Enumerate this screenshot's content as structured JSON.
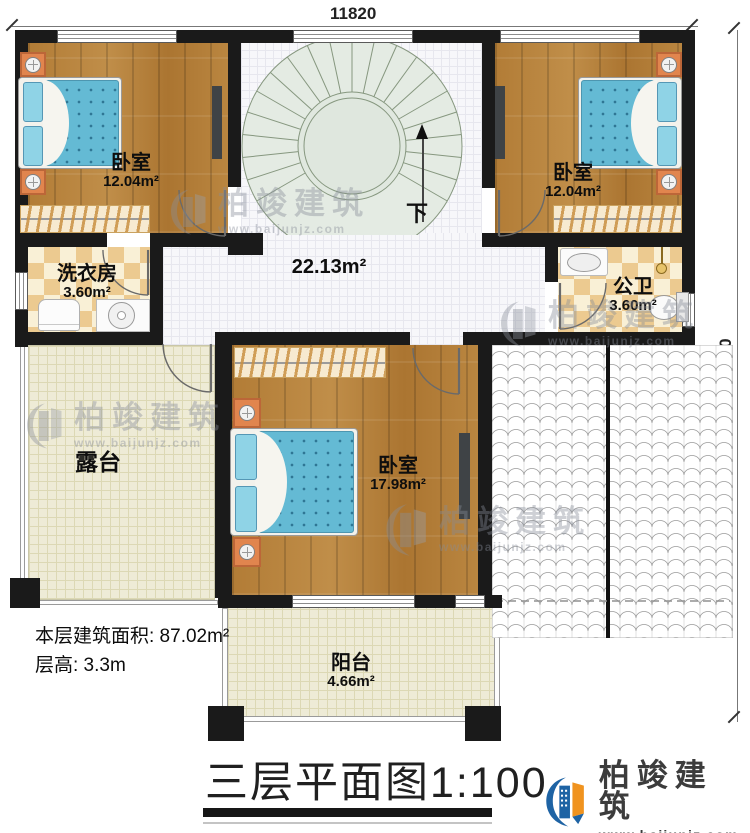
{
  "plan": {
    "title": "三层平面图1:100",
    "dim_top": "11820",
    "dim_right": "12120",
    "stairs_label": "下",
    "notes": {
      "area": "本层建筑面积: 87.02m²",
      "height": "层高: 3.3m"
    }
  },
  "rooms": {
    "bedroom_tl": {
      "name": "卧室",
      "area": "12.04m²"
    },
    "bedroom_tr": {
      "name": "卧室",
      "area": "12.04m²"
    },
    "laundry": {
      "name": "洗衣房",
      "area": "3.60m²"
    },
    "bathroom": {
      "name": "公卫",
      "area": "3.60m²"
    },
    "hall": {
      "area": "22.13m²"
    },
    "bedroom_b": {
      "name": "卧室",
      "area": "17.98m²"
    },
    "terrace": {
      "name": "露台"
    },
    "balcony": {
      "name": "阳台",
      "area": "4.66m²"
    }
  },
  "branding": {
    "watermark_name": "柏竣建筑",
    "watermark_url": "www.baijunjz.com",
    "logo_name": "柏竣建筑",
    "logo_url": "www.baijunjz.com"
  },
  "colors": {
    "wall": "#1a1a1a",
    "wood_floor": "#b5813d",
    "mattress_blue": "#64bad4",
    "stair_green": "#e4ebe3",
    "checker_tan": "#ecca90",
    "terrace_beige": "#eeebd6",
    "logo_blue": "#1e63a4",
    "logo_orange": "#f0931f"
  }
}
